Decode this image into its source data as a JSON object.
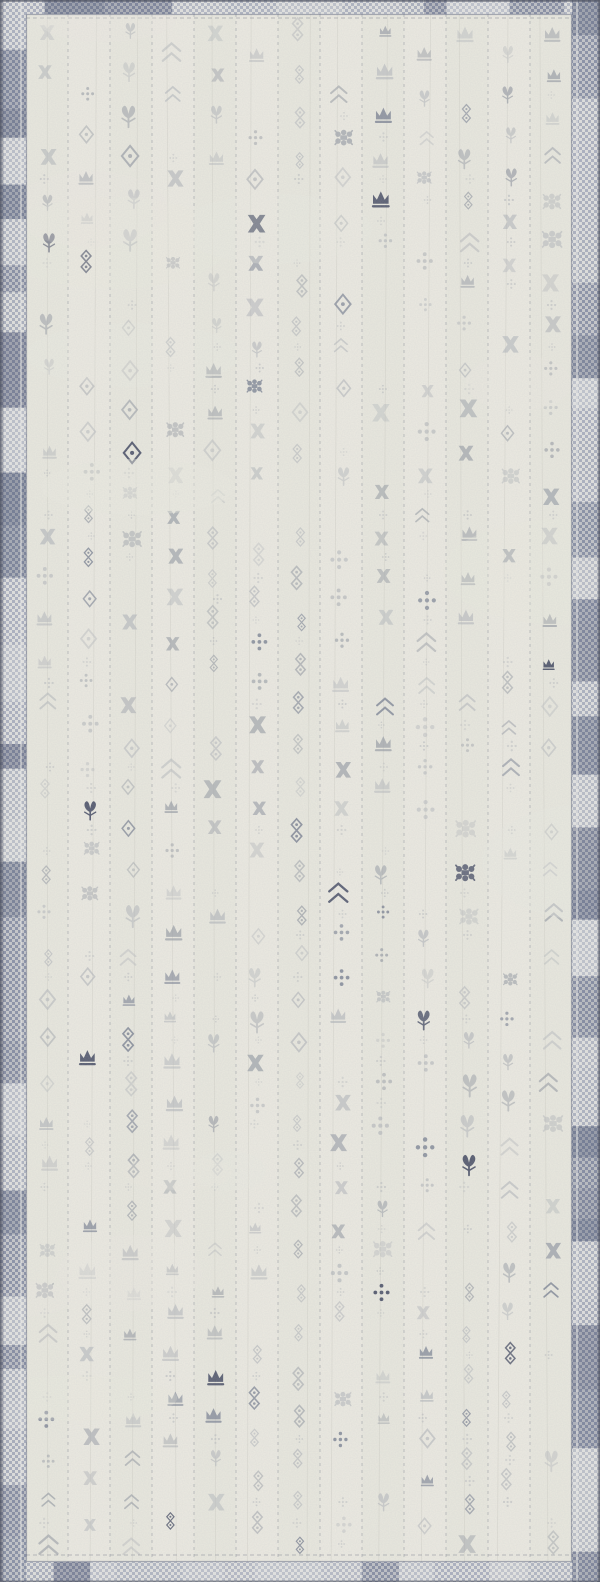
{
  "image": {
    "type": "product-photo",
    "subject": "runner-rug",
    "alt": "Ivory and blue distressed runner rug with vertical bands of faded gray-blue tribal motifs and a checked plaid navy border"
  },
  "rug": {
    "width": 600,
    "height": 1582,
    "seed": 11,
    "palette": {
      "field": "#ECEAE1",
      "field_tint": "#E2E1D7",
      "streak": "#CBCAC1",
      "motif_light": "#B3B6BA",
      "motif_mid": "#979CA4",
      "motif_slate": "#7D8494",
      "accent_navy": "#4C5268",
      "separator": "#8B8F99",
      "border_blue": "#969DB0",
      "border_light": "#DCDCDA",
      "border_navy": "#4A5370",
      "border_pale": "#EDEDEA",
      "edge_dark": "#3E4352"
    },
    "border": {
      "top": 14,
      "bottom": 20,
      "left": 26,
      "right": 28,
      "checker": 6
    },
    "field_layout": {
      "columns": 13,
      "row_spacing": 42,
      "row_start_offset": 18,
      "skip_chance": 0.16,
      "interdot_chance": 0.32,
      "navy_chance": 0.045
    },
    "motif_types": [
      "diamond",
      "floret",
      "gear",
      "chevron",
      "cross",
      "dots",
      "lattice",
      "crown"
    ],
    "worn_patches": 14,
    "grain_opacity": 0.24
  }
}
